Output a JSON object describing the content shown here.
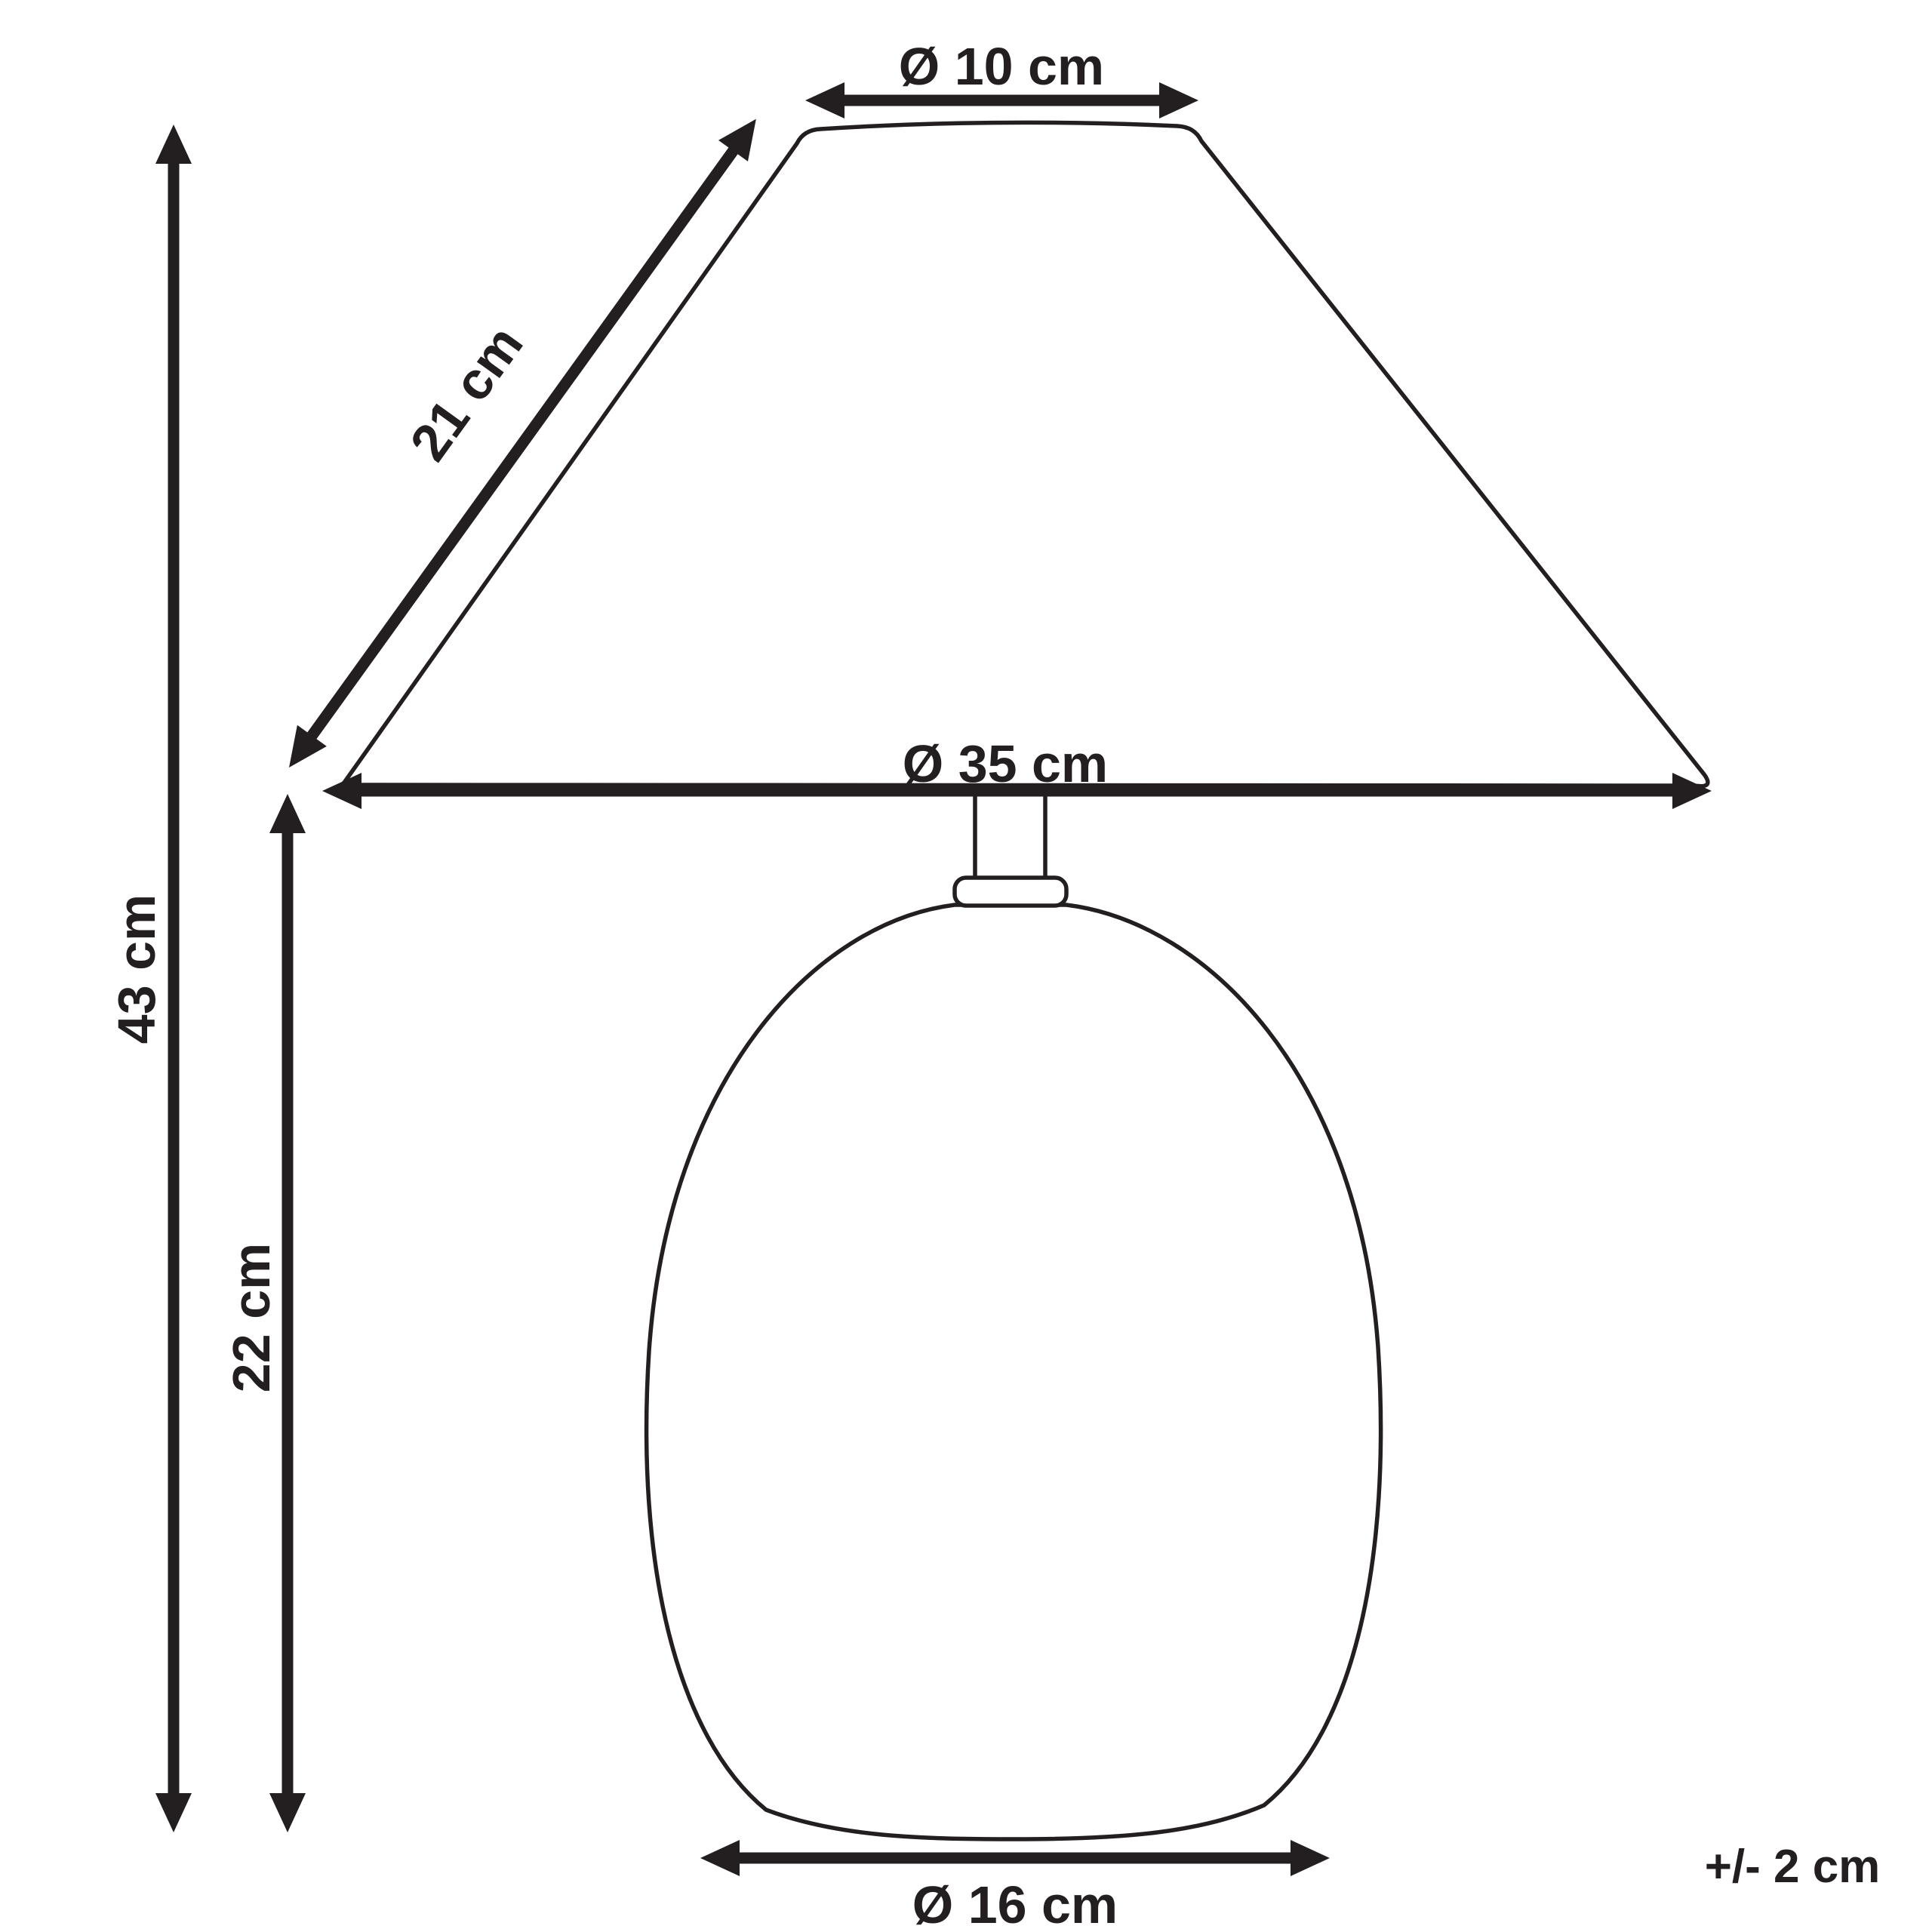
{
  "diagram_title": "Table lamp dimensions diagram",
  "labels": {
    "shade_top_diameter": "Ø 10 cm",
    "shade_slant_height": "21 cm",
    "shade_bottom_diameter": "Ø 35 cm",
    "total_height": "43 cm",
    "base_height": "22 cm",
    "base_diameter": "Ø 16 cm",
    "tolerance": "+/- 2 cm"
  },
  "measurements": [
    {
      "name": "shade top diameter",
      "label": "Ø 10 cm",
      "value_cm": 10
    },
    {
      "name": "shade slant height",
      "label": "21 cm",
      "value_cm": 21
    },
    {
      "name": "shade bottom diameter",
      "label": "Ø 35 cm",
      "value_cm": 35
    },
    {
      "name": "total height",
      "label": "43 cm",
      "value_cm": 43
    },
    {
      "name": "base height",
      "label": "22 cm",
      "value_cm": 22
    },
    {
      "name": "base diameter",
      "label": "Ø 16 cm",
      "value_cm": 16
    },
    {
      "name": "tolerance",
      "label": "+/- 2 cm",
      "value_cm": 2
    }
  ],
  "colors": {
    "line": "#231f20",
    "background": "#ffffff"
  }
}
